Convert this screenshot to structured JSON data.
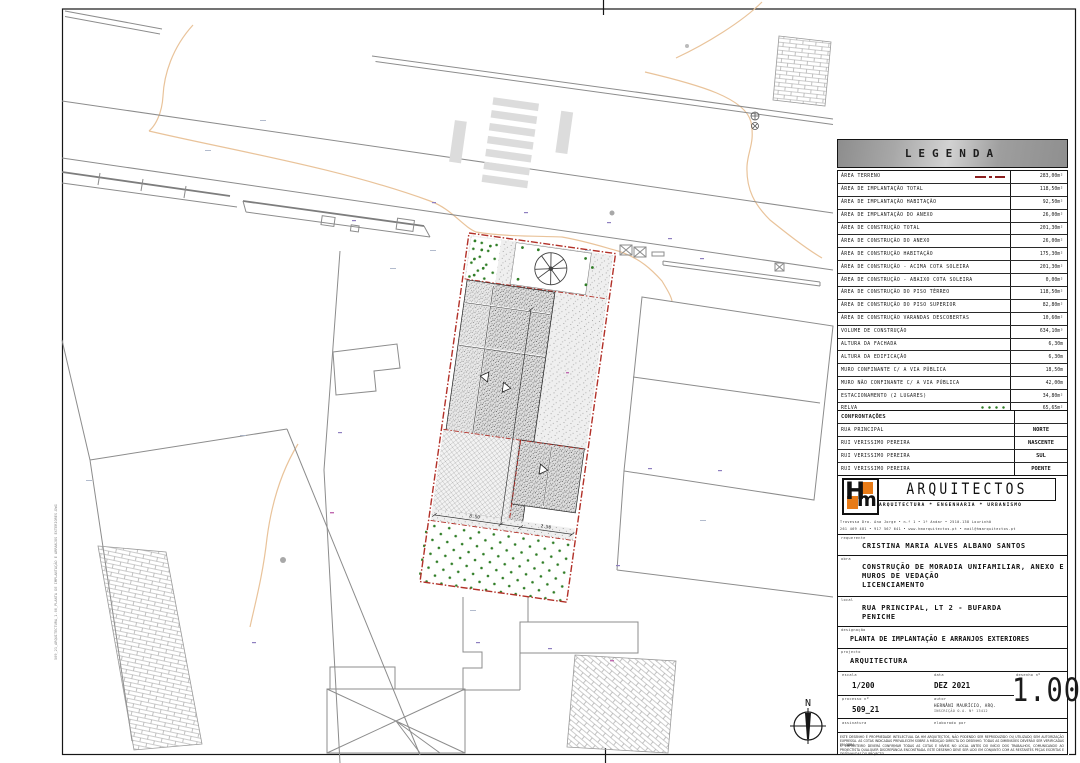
{
  "legend": {
    "title": "LEGENDA",
    "rows": [
      {
        "label": "ÁREA TERRENO",
        "value": "283,00m²",
        "symbol": "property-line-red"
      },
      {
        "label": "ÁREA DE IMPLANTAÇÃO TOTAL",
        "value": "118,50m²"
      },
      {
        "label": "ÁREA DE IMPLANTAÇÃO HABITAÇÃO",
        "value": "92,50m²"
      },
      {
        "label": "ÁREA DE IMPLANTAÇÃO DO ANEXO",
        "value": "26,00m²"
      },
      {
        "label": "ÁREA DE CONSTRUÇÃO TOTAL",
        "value": "201,30m²"
      },
      {
        "label": "ÁREA DE CONSTRUÇÃO DO ANEXO",
        "value": "26,00m²"
      },
      {
        "label": "ÁREA DE CONSTRUÇÃO HABITAÇÃO",
        "value": "175,30m²"
      },
      {
        "label": "ÁREA DE CONSTRUÇÃO - ACIMA COTA SOLEIRA",
        "value": "201,30m²"
      },
      {
        "label": "ÁREA DE CONSTRUÇÃO - ABAIXO COTA SOLEIRA",
        "value": "0,00m²"
      },
      {
        "label": "ÁREA DE CONSTRUÇÃO DO PISO TÉRREO",
        "value": "118,50m²"
      },
      {
        "label": "ÁREA DE CONSTRUÇÃO DO PISO SUPERIOR",
        "value": "82,80m²"
      },
      {
        "label": "ÁREA DE CONSTRUÇÃO VARANDAS DESCOBERTAS",
        "value": "10,60m²"
      },
      {
        "label": "VOLUME DE CONSTRUÇÃO",
        "value": "634,10m³"
      },
      {
        "label": "ALTURA DA FACHADA",
        "value": "6,30m"
      },
      {
        "label": "ALTURA DA EDIFICAÇÃO",
        "value": "6,30m"
      },
      {
        "label": "MURO CONFINANTE C/ A VIA PÚBLICA",
        "value": "18,50m"
      },
      {
        "label": "MURO NÃO CONFINANTE C/ A VIA PÚBLICA",
        "value": "42,00m"
      },
      {
        "label": "ESTACIONAMENTO (2 LUGARES)",
        "value": "34,80m²"
      },
      {
        "label": "RELVA",
        "value": "65,65m²",
        "symbol": "grass-dots"
      },
      {
        "label": "PAVÊ",
        "value": "96,60m²",
        "symbol": "pave-hatch"
      }
    ]
  },
  "confrontacoes": {
    "title": "CONFRONTAÇÕES",
    "rows": [
      {
        "name": "RUA PRINCIPAL",
        "side": "NORTE"
      },
      {
        "name": "RUI VERISSIMO PEREIRA",
        "side": "NASCENTE"
      },
      {
        "name": "RUI VERISSIMO PEREIRA",
        "side": "SUL"
      },
      {
        "name": "RUI VERISSIMO PEREIRA",
        "side": "POENTE"
      }
    ]
  },
  "firm": {
    "logo_initial_h": "H",
    "logo_initial_m": "m",
    "logo_name": "ARQUITECTOS",
    "tagline": "ARQUITECTURA * ENGENHARIA * URBANISMO",
    "address_line": "Travessa Dra. Ana Jorge • n.º 1 • 1º Andar • 2510-138 Lourinhã",
    "contacts_line": "261 469 481 • 917 567 641 • www.hmarquitectos.pt • mail@hmarquitectos.pt"
  },
  "titleblock": {
    "labels": {
      "requerente": "requerente",
      "obra": "obra",
      "local": "local",
      "designacao": "designação",
      "projecto": "projecto",
      "escala": "escala",
      "data": "data",
      "desenho": "desenho nº",
      "processo": "processo nº",
      "autor": "autor",
      "assinatura": "assinatura",
      "elaborado": "elaborado por"
    },
    "requerente": "CRISTINA MARIA ALVES ALBANO SANTOS",
    "obra_lines": [
      "CONSTRUÇÃO DE MORADIA UNIFAMILIAR, ANEXO E",
      "MUROS DE VEDAÇÃO",
      "LICENCIAMENTO"
    ],
    "local_lines": [
      "RUA PRINCIPAL, LT 2 - BUFARDA",
      "PENICHE"
    ],
    "designacao": "PLANTA DE IMPLANTAÇÃO E ARRANJOS EXTERIORES",
    "projecto": "ARQUITECTURA",
    "escala": "1/200",
    "data": "DEZ 2021",
    "desenho_numero": "1.00",
    "processo": "509_21",
    "autor_lines": [
      "HERNÂNI MAURÍCIO, ARQ.",
      "INSCRIÇÃO O.A. Nº 13412"
    ],
    "fine_print": [
      "ESTE DESENHO É PROPRIEDADE INTELECTUAL DA HM ARQUITECTOS, NÃO PODENDO SER REPRODUZIDO OU UTILIZADO SEM AUTORIZAÇÃO EXPRESSA. AS COTAS INDICADAS PREVALECEM SOBRE A MEDIÇÃO DIRECTA DO DESENHO. TODAS AS DIMENSÕES DEVERÃO SER VERIFICADAS EM OBRA.",
      "O EMPREITEIRO DEVERÁ CONFIRMAR TODAS AS COTAS E NÍVEIS NO LOCAL ANTES DO INÍCIO DOS TRABALHOS, COMUNICANDO AO PROJECTISTA QUALQUER DISCREPÂNCIA ENCONTRADA. ESTE DESENHO DEVE SER LIDO EM CONJUNTO COM AS RESTANTES PEÇAS ESCRITAS E DESENHADAS DO PROJECTO."
    ]
  },
  "map": {
    "north_label": "N",
    "dimensions": [
      "8.50",
      "2.50"
    ],
    "margin_note": "509_21_ARQUITECTURA_1.00_PLANTA DE IMPLANTAÇÃO E ARRANJOS EXTERIORES.DWG"
  },
  "colors": {
    "lot_boundary_red": "#b23028",
    "contour_orange": "#e9c39a",
    "grass_green": "#2f7d26",
    "logo_orange": "#e87b17"
  }
}
